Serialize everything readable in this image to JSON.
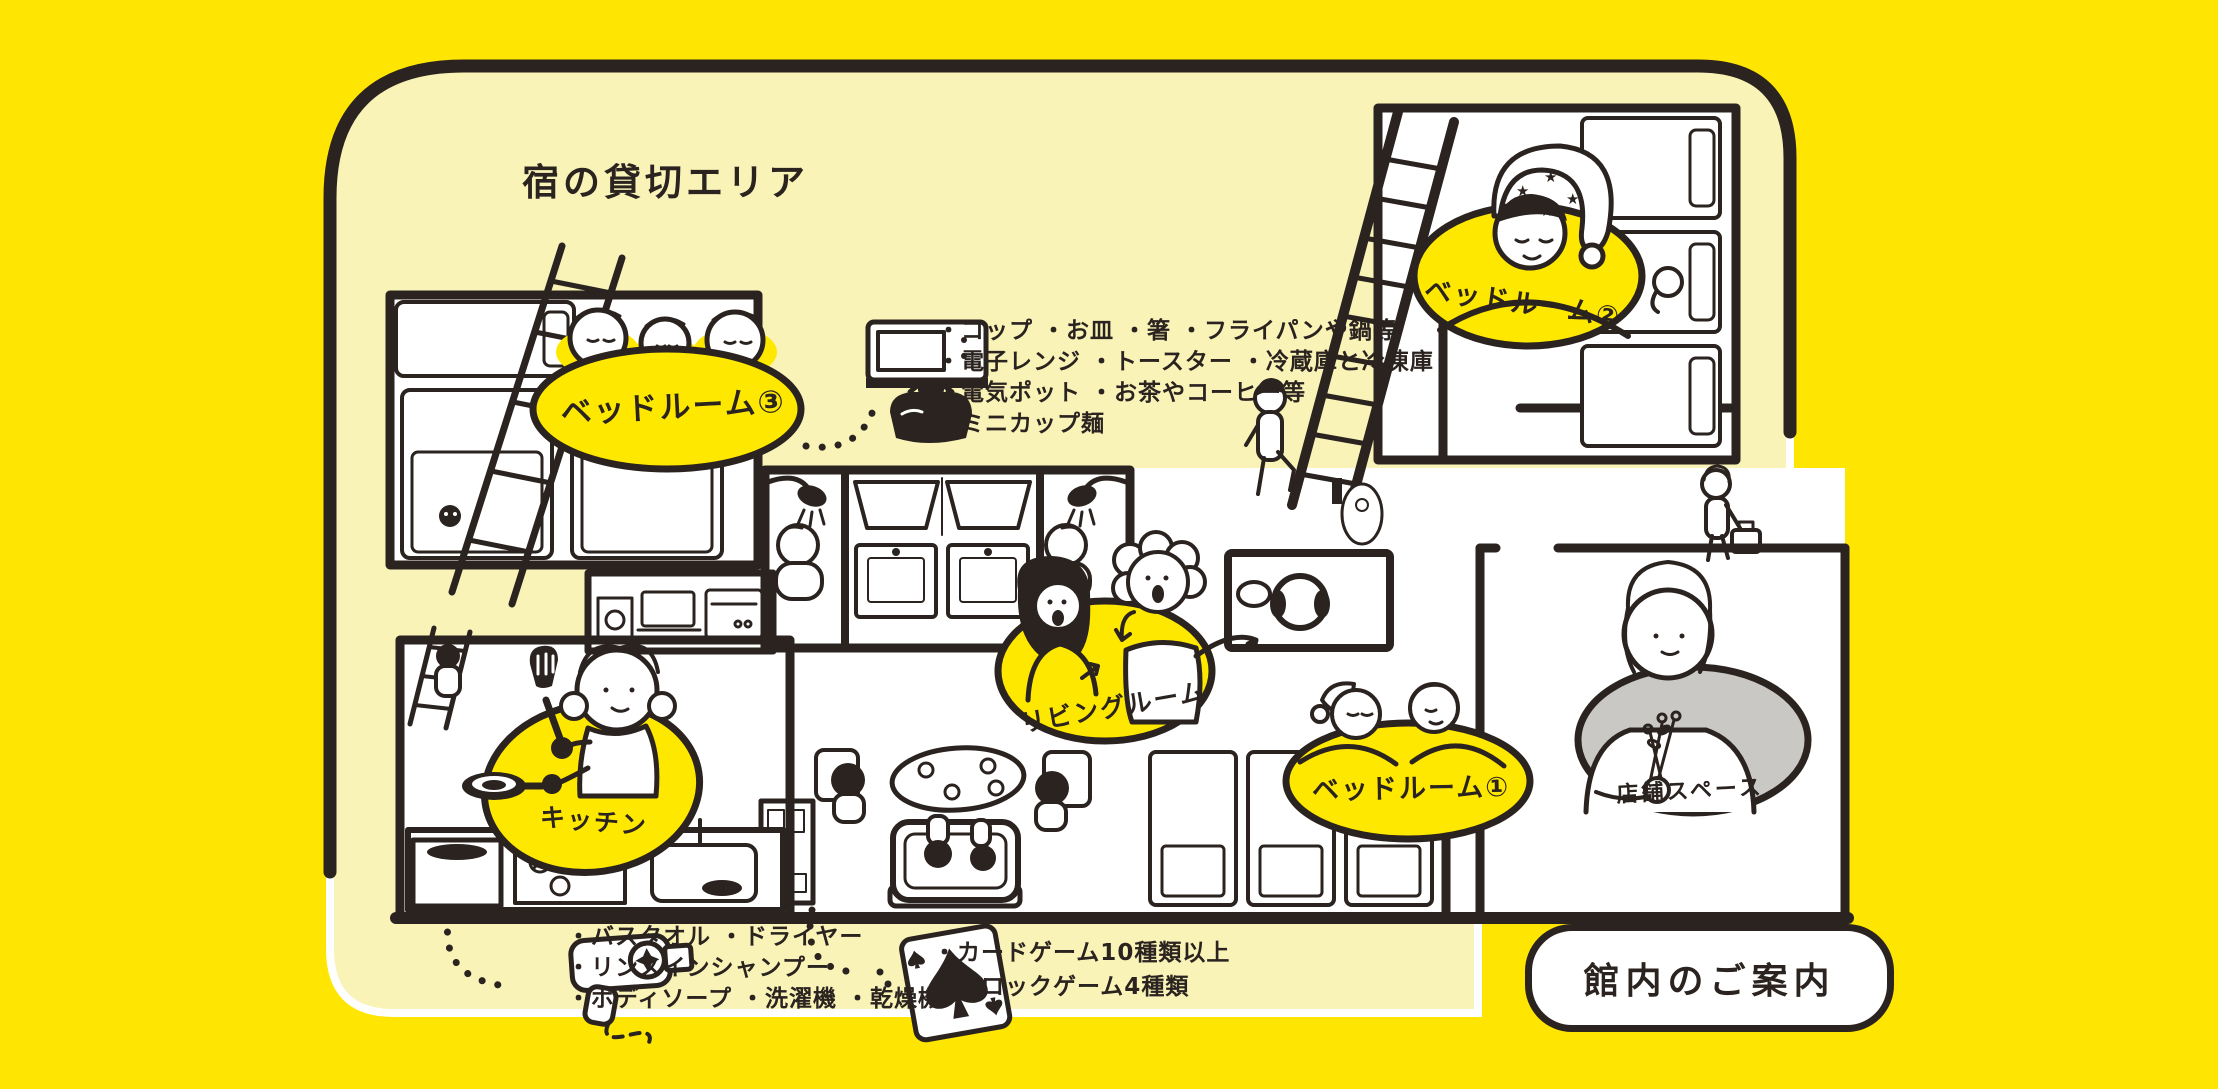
{
  "page": {
    "background": "#FFE502",
    "panel_bg": "#F9F3B8",
    "ink": "#2A231F",
    "accent_yellow": "#FFE800",
    "gray": "#C9C8C5",
    "white": "#FFFFFF"
  },
  "header": {
    "title": "宿の貸切エリア"
  },
  "rooms": {
    "bedroom3": {
      "label": "ベッドルーム③"
    },
    "bedroom2": {
      "label": "ベッドルーム②"
    },
    "bedroom1": {
      "label": "ベッドルーム①"
    },
    "living": {
      "label": "リビングルーム"
    },
    "kitchen": {
      "label": "キッチン"
    },
    "shop": {
      "label": "店舗スペース"
    }
  },
  "amenities": {
    "kitchen_items": {
      "lines": [
        "・コップ ・お皿 ・箸 ・フライパンや鍋等",
        "・電子レンジ ・トースター ・冷蔵庫と冷凍庫",
        "・電気ポット ・お茶やコーヒー等",
        "・ミニカップ麺"
      ]
    },
    "bath_items": {
      "lines": [
        "・バスタオル ・ドライヤー",
        "・リンスインシャンプー",
        "・ボディソープ ・洗濯機 ・乾燥機"
      ]
    },
    "game_items": {
      "lines": [
        "・カードゲーム10種類以上",
        "・ブロックゲーム4種類"
      ]
    }
  },
  "footer": {
    "guide_button": "館内のご案内"
  },
  "icons": {
    "kitchenware": "microwave-and-kettle-doodle",
    "hairdryer": "hairdryer-doodle",
    "playing_card": "ace-of-spades-doodle"
  }
}
